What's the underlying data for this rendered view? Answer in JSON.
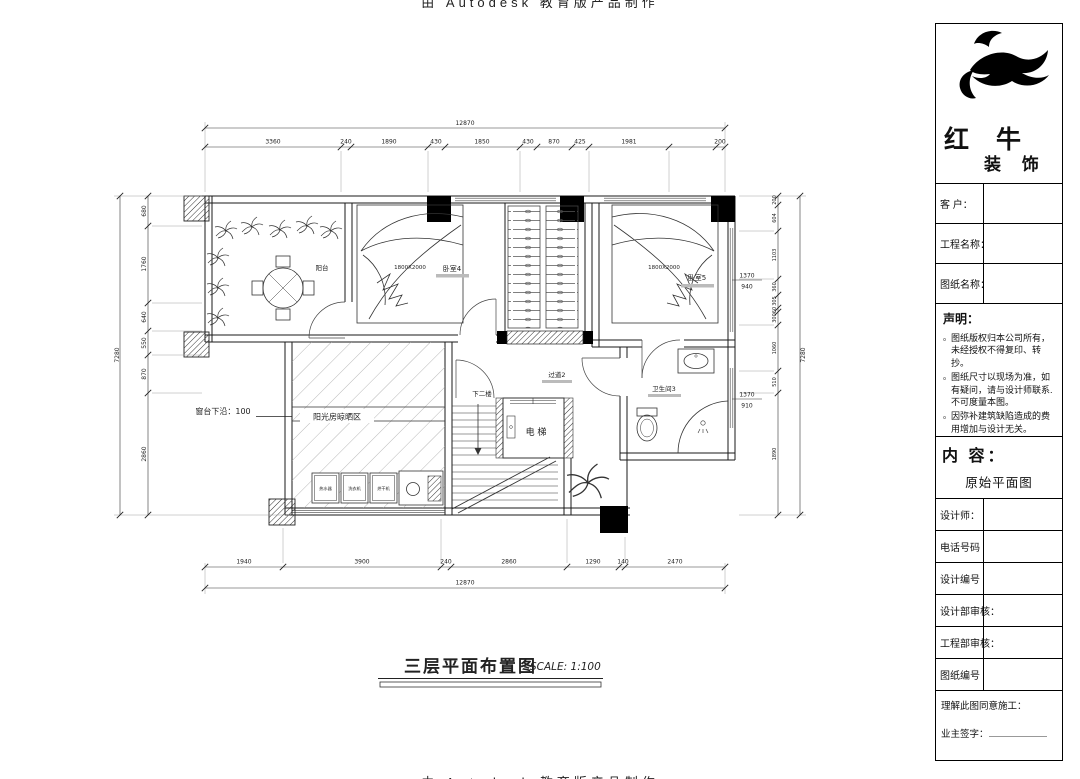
{
  "watermark": {
    "top": "由 Autodesk 教育版产品制作",
    "bottom": "由 Autodesk 教育版产品制作"
  },
  "title_block": {
    "brand": {
      "line1": "红 牛",
      "line2": "装 饰"
    },
    "fields": [
      {
        "label": "客  户："
      },
      {
        "label": "工程名称："
      },
      {
        "label": "图纸名称："
      }
    ],
    "statement": {
      "heading": "声明：",
      "bullet": "。",
      "items": [
        "图纸版权归本公司所有，未经授权不得复印、转抄。",
        "图纸尺寸以现场为准，如有疑问，请与设计师联系.不可度量本图。",
        "因弥补建筑缺陷造成的费用增加与设计无关。"
      ]
    },
    "content": {
      "heading": "内 容：",
      "value": "原始平面图"
    },
    "rows": [
      {
        "label": "设计师："
      },
      {
        "label": "电话号码"
      },
      {
        "label": "设计编号"
      },
      {
        "label": "设计部审核："
      },
      {
        "label": "工程部审核："
      },
      {
        "label": "图纸编号"
      }
    ],
    "signature": {
      "line1": "理解此图同意施工：",
      "line2": "业主签字："
    }
  },
  "plan": {
    "labels": {
      "balcony": "阳台",
      "bedroom4": "卧室4",
      "bedroom5": "卧室5",
      "bed4_size": "1800X2000",
      "bed5_size": "1800X2000",
      "corridor": "过道2",
      "bathroom": "卫生间3",
      "elevator": "电 梯",
      "stairs_down": "下二楼",
      "sunroom": "阳光房晾晒区",
      "sill_note": "窗台下沿：100",
      "appliance1": "热水器",
      "appliance2": "洗衣机",
      "appliance3": "烘干机"
    },
    "window_marks": {
      "m1_top": "1370",
      "m1_bottom": "940",
      "m2_top": "1370",
      "m2_bottom": "910"
    },
    "dims": {
      "top_total": "12870",
      "top": [
        "3360",
        "240",
        "1890",
        "430",
        "1850",
        "430",
        "870",
        "425",
        "1981",
        "200"
      ],
      "bottom_total": "12870",
      "bottom": [
        "1940",
        "3900",
        "240",
        "2860",
        "1290",
        "140",
        "2470"
      ],
      "left_total": "7280",
      "left": [
        "680",
        "1760",
        "640",
        "550",
        "870",
        "2860"
      ],
      "right_total": "7280",
      "right": [
        "200",
        "604",
        "1103",
        "360",
        "305",
        "60",
        "300",
        "1060",
        "510",
        "1890"
      ]
    }
  },
  "drawing_title": {
    "text": "三层平面布置图",
    "scale": "SCALE: 1:100"
  }
}
